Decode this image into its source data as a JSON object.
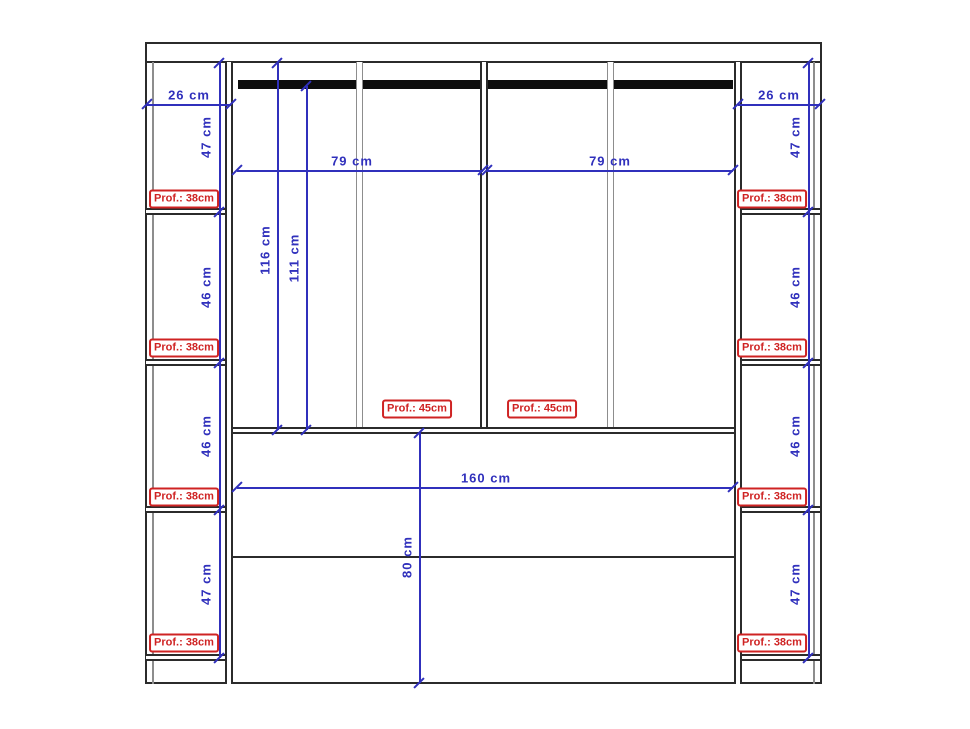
{
  "colors": {
    "dim_blue": "#3030bc",
    "depth_red": "#cf2323",
    "line_dark": "#2b2b2b",
    "line_gray": "#8d8d8d",
    "rail_black": "#0d0d0d",
    "bg": "#ffffff"
  },
  "drawing": {
    "dimension_lines": [
      {
        "x1": 147,
        "y1": 104,
        "x2": 231,
        "y2": 104
      },
      {
        "x1": 738,
        "y1": 104,
        "x2": 820,
        "y2": 104
      },
      {
        "x1": 219,
        "y1": 63,
        "x2": 219,
        "y2": 658
      },
      {
        "x1": 808,
        "y1": 63,
        "x2": 808,
        "y2": 658
      },
      {
        "x1": 237,
        "y1": 170,
        "x2": 483,
        "y2": 170
      },
      {
        "x1": 487,
        "y1": 170,
        "x2": 733,
        "y2": 170
      },
      {
        "x1": 277,
        "y1": 63,
        "x2": 277,
        "y2": 430
      },
      {
        "x1": 306,
        "y1": 86,
        "x2": 306,
        "y2": 430
      },
      {
        "x1": 237,
        "y1": 487,
        "x2": 733,
        "y2": 487
      },
      {
        "x1": 419,
        "y1": 433,
        "x2": 419,
        "y2": 683
      }
    ],
    "dimension_ticks": [
      {
        "x": 147,
        "y": 104
      },
      {
        "x": 231,
        "y": 104
      },
      {
        "x": 738,
        "y": 104
      },
      {
        "x": 820,
        "y": 104
      },
      {
        "x": 219,
        "y": 63
      },
      {
        "x": 219,
        "y": 212
      },
      {
        "x": 219,
        "y": 363
      },
      {
        "x": 219,
        "y": 510
      },
      {
        "x": 219,
        "y": 658
      },
      {
        "x": 808,
        "y": 63
      },
      {
        "x": 808,
        "y": 212
      },
      {
        "x": 808,
        "y": 363
      },
      {
        "x": 808,
        "y": 510
      },
      {
        "x": 808,
        "y": 658
      },
      {
        "x": 237,
        "y": 170
      },
      {
        "x": 483,
        "y": 170
      },
      {
        "x": 487,
        "y": 170
      },
      {
        "x": 733,
        "y": 170
      },
      {
        "x": 277,
        "y": 63
      },
      {
        "x": 277,
        "y": 430
      },
      {
        "x": 306,
        "y": 86
      },
      {
        "x": 306,
        "y": 430
      },
      {
        "x": 237,
        "y": 487
      },
      {
        "x": 733,
        "y": 487
      },
      {
        "x": 419,
        "y": 433
      },
      {
        "x": 419,
        "y": 683
      }
    ],
    "dimension_labels": [
      {
        "text": "26 cm",
        "x": 189,
        "y": 95,
        "rot": 0
      },
      {
        "text": "26 cm",
        "x": 779,
        "y": 95,
        "rot": 0
      },
      {
        "text": "47 cm",
        "x": 206,
        "y": 137,
        "rot": -90
      },
      {
        "text": "46 cm",
        "x": 206,
        "y": 287,
        "rot": -90
      },
      {
        "text": "46 cm",
        "x": 206,
        "y": 436,
        "rot": -90
      },
      {
        "text": "47 cm",
        "x": 206,
        "y": 584,
        "rot": -90
      },
      {
        "text": "47 cm",
        "x": 795,
        "y": 137,
        "rot": -90
      },
      {
        "text": "46 cm",
        "x": 795,
        "y": 287,
        "rot": -90
      },
      {
        "text": "46 cm",
        "x": 795,
        "y": 436,
        "rot": -90
      },
      {
        "text": "47 cm",
        "x": 795,
        "y": 584,
        "rot": -90
      },
      {
        "text": "79 cm",
        "x": 352,
        "y": 161,
        "rot": 0
      },
      {
        "text": "79 cm",
        "x": 610,
        "y": 161,
        "rot": 0
      },
      {
        "text": "116 cm",
        "x": 265,
        "y": 250,
        "rot": -90
      },
      {
        "text": "111 cm",
        "x": 294,
        "y": 258,
        "rot": -90
      },
      {
        "text": "160 cm",
        "x": 486,
        "y": 478,
        "rot": 0
      },
      {
        "text": "80 cm",
        "x": 407,
        "y": 557,
        "rot": -90
      }
    ],
    "depth_labels": [
      {
        "text": "Prof.: 38cm",
        "x": 184,
        "y": 199
      },
      {
        "text": "Prof.: 38cm",
        "x": 184,
        "y": 348
      },
      {
        "text": "Prof.: 38cm",
        "x": 184,
        "y": 497
      },
      {
        "text": "Prof.: 38cm",
        "x": 184,
        "y": 643
      },
      {
        "text": "Prof.: 38cm",
        "x": 772,
        "y": 199
      },
      {
        "text": "Prof.: 38cm",
        "x": 772,
        "y": 348
      },
      {
        "text": "Prof.: 38cm",
        "x": 772,
        "y": 497
      },
      {
        "text": "Prof.: 38cm",
        "x": 772,
        "y": 643
      },
      {
        "text": "Prof.: 45cm",
        "x": 417,
        "y": 409
      },
      {
        "text": "Prof.: 45cm",
        "x": 542,
        "y": 409
      }
    ]
  }
}
